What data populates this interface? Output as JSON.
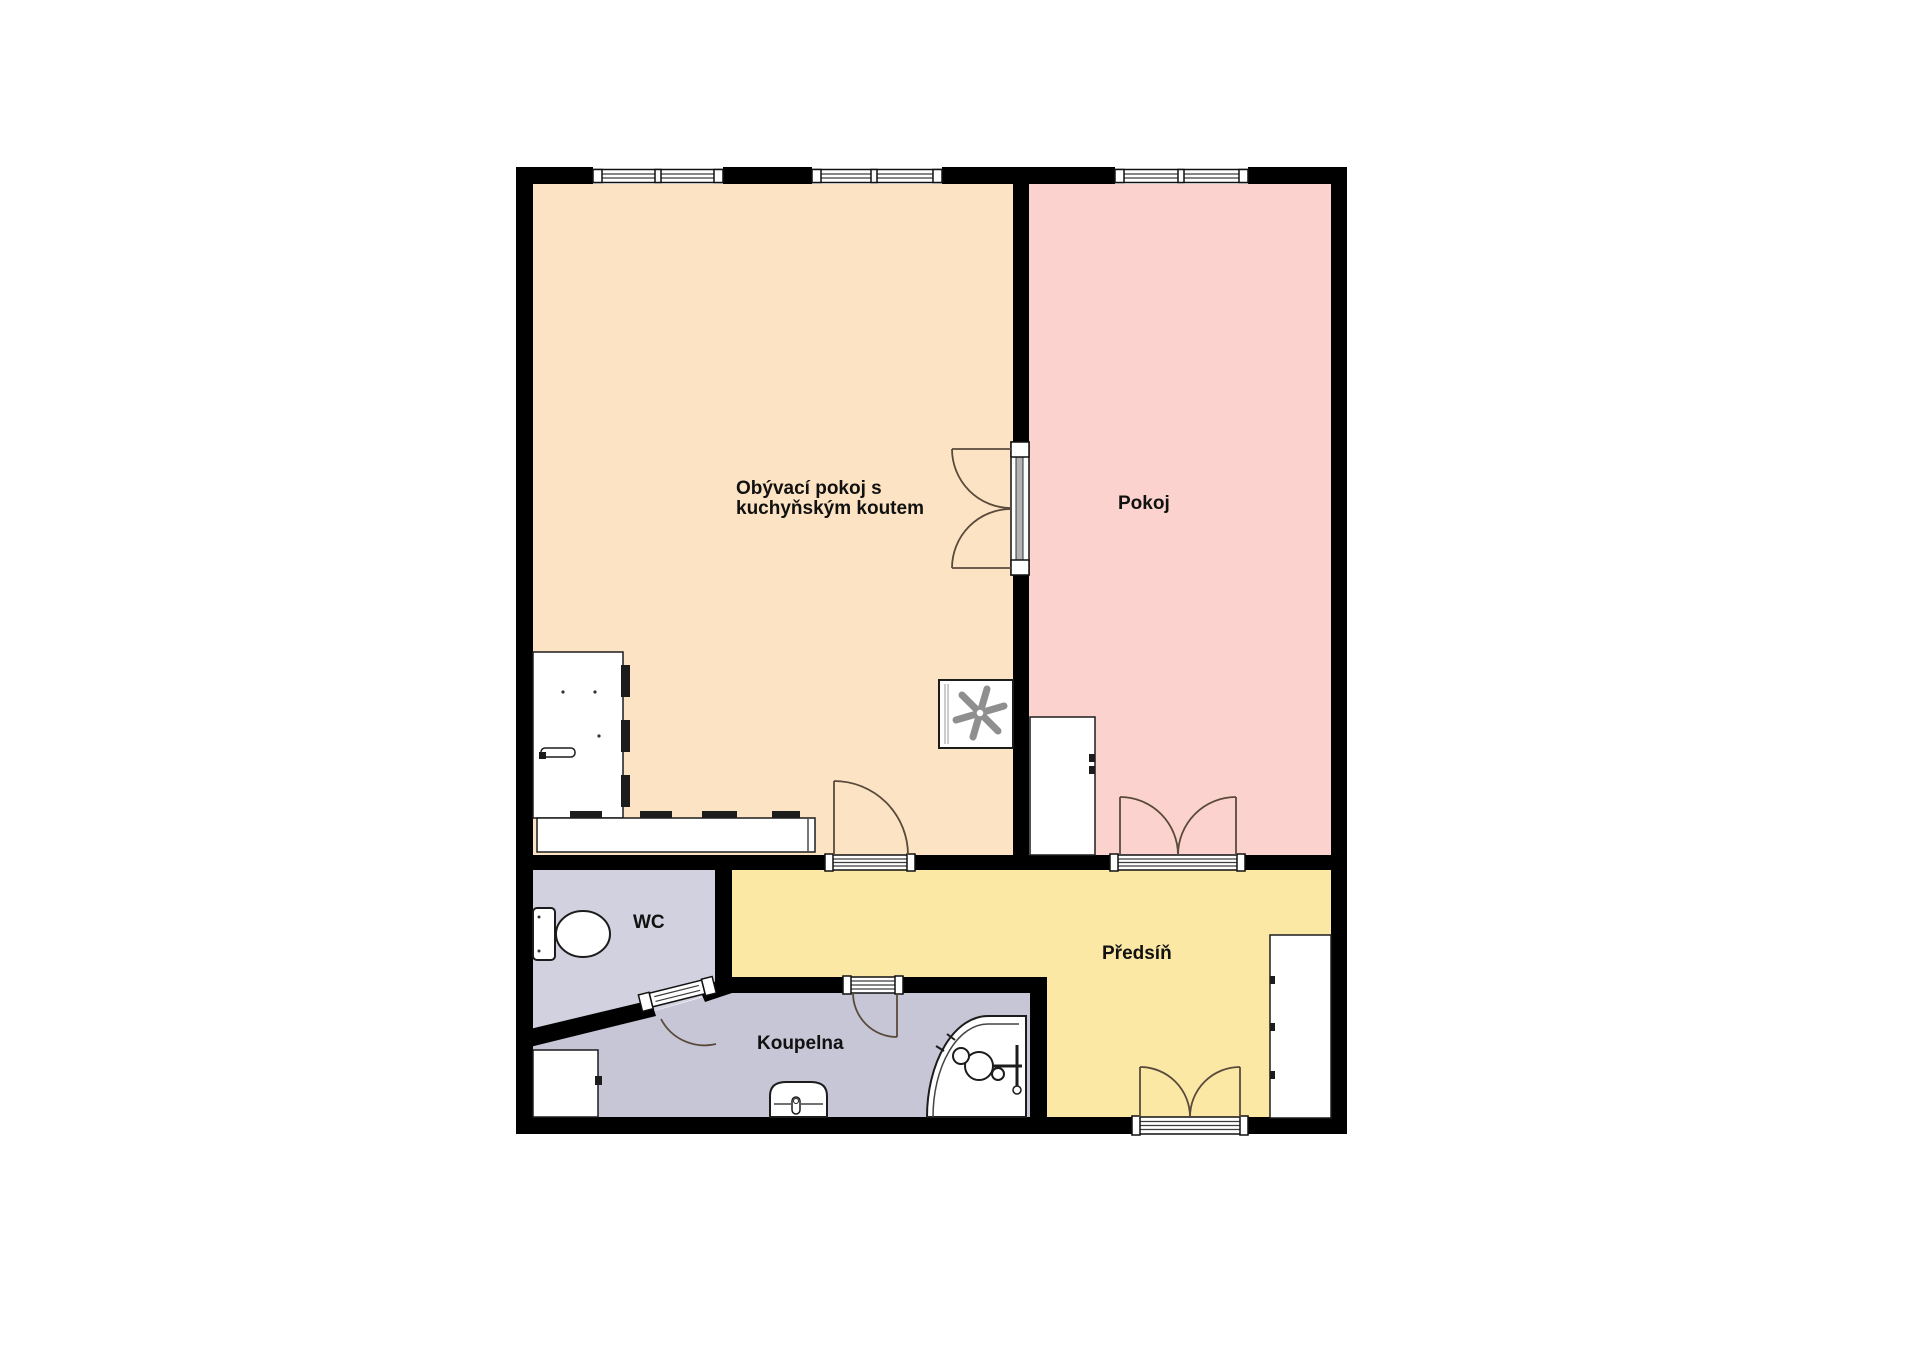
{
  "plan_title": "apartment-floor-plan",
  "rooms": {
    "living": {
      "label_line1": "Obývací pokoj s",
      "label_line2": "kuchyňským koutem",
      "color": "#fce3c3"
    },
    "pokoj": {
      "label": "Pokoj",
      "color": "#fbd2cd"
    },
    "wc": {
      "label": "WC",
      "color": "#d1d1df"
    },
    "predsin": {
      "label": "Předsíň",
      "color": "#fbe8a5"
    },
    "koupelna": {
      "label": "Koupelna",
      "color": "#c6c6d7"
    }
  },
  "style": {
    "background": "#ffffff",
    "wall_color": "#000000",
    "door_arc_color": "#5a4a3c",
    "fixture_outline": "#1c1c1c"
  },
  "icons": {
    "window": "double-line-window-icon",
    "door_swing": "quarter-arc-door-icon",
    "stove": "asterisk-stove-icon",
    "toilet": "toilet-icon",
    "bathtub": "corner-bathtub-icon",
    "sink": "washbasin-icon"
  }
}
